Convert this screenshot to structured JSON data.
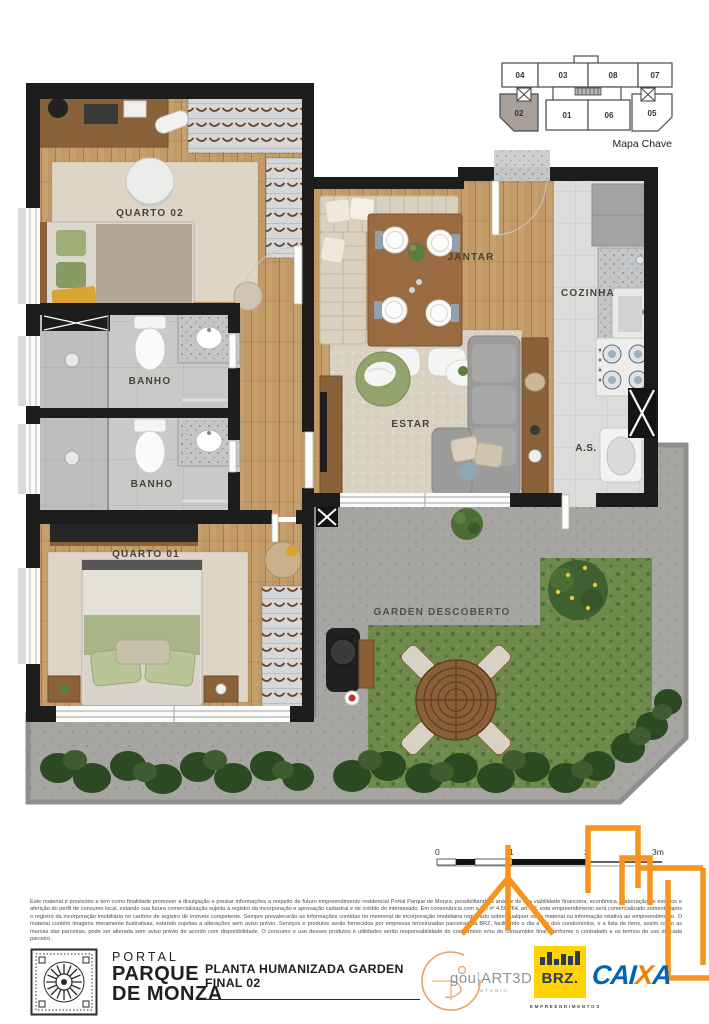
{
  "key_map": {
    "title": "Mapa Chave",
    "units": [
      "04",
      "03",
      "08",
      "07",
      "02",
      "01",
      "06",
      "05"
    ],
    "highlighted_unit": "02"
  },
  "rooms": {
    "quarto02": "QUARTO 02",
    "banho1": "BANHO",
    "banho2": "BANHO",
    "quarto01": "QUARTO 01",
    "jantar": "JANTAR",
    "cozinha": "COZINHA",
    "estar": "ESTAR",
    "as": "A.S.",
    "garden": "GARDEN DESCOBERTO"
  },
  "scale_bar": {
    "t0": "0",
    "t1": "1",
    "t2": "2",
    "t3": "3m"
  },
  "disclaimer": "Este material é provisório e tem como finalidade promover a divulgação e prestar informações a respeito de futuro empreendimento residencial Portal Parque de Monza, possibilitando a análise de sua viabilidade financeira, econômica, elaboração de estudos e aferição do perfil de consumo local, estando sua futura comercialização sujeita à registro da incorporação e aprovação cadastral e de crédito do interessado. Em consonância com a Lei nº 4.591/64, art. 32, este empreendimento será comercializado somente após o registro da incorporação imobiliária no cartório de registro de imóveis competente. Sempre prevalecerão as informações contidas no memorial de incorporação imobiliária registrado sobre qualquer outro material ou informação relativa ao empreendimento. O material contém imagens meramente ilustrativas, estando sujeitas a alterações sem aviso prévio. Serviços e produtos serão fornecidos por empresas terceirizadas parceiras da BRZ, facilitando o dia a dia dos condomínios, e a lista de itens, assim como as marcas das parceiras, pode ser alterada sem aviso prévio de acordo com disponibilidade. O consumo e uso desses produtos e utilidades serão responsabilidade do condomínio e/ou do consumidor final, conforme o contratado e os termos do uso de cada parceiro.",
  "footer": {
    "brand_line1": "PORTAL",
    "brand_line2": "PARQUE",
    "brand_line3": "DE MONZA",
    "plan_title": "PLANTA HUMANIZADA GARDEN FINAL 02",
    "studio_name_1": "gou",
    "studio_name_2": "ART3D",
    "studio_sub": "STUDIO",
    "builder_name": "BRZ.",
    "builder_sub": "EMPREENDIMENTOS",
    "bank_pre": "CAI",
    "bank_x": "X",
    "bank_post": "A"
  },
  "colors": {
    "accent_orange": "#F7941E",
    "caixa_blue": "#0066B3",
    "brz_yellow": "#FFD402",
    "wall_black": "#1d1d1d",
    "wood_floor": "#C39A65",
    "grass_green": "#6E8B4B",
    "concrete_gray": "#A6A5A2"
  }
}
